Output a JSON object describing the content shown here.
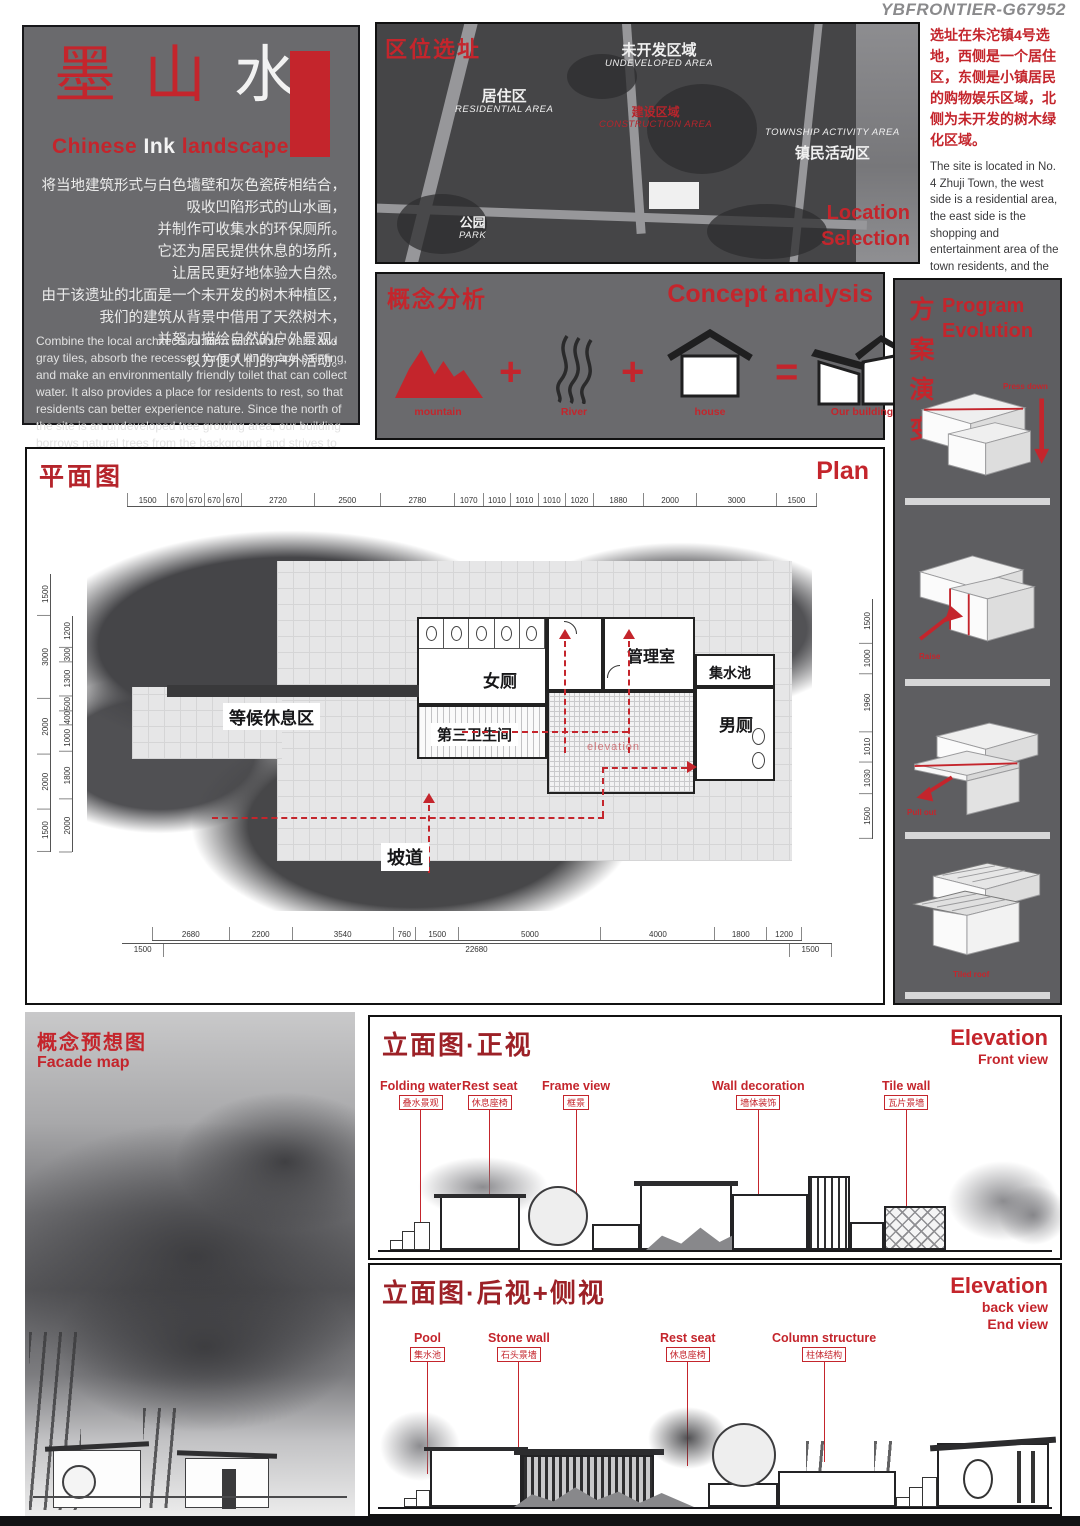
{
  "watermark": "YBFRONTIER-G67952",
  "intro": {
    "title_chars": [
      "墨",
      "山",
      "水"
    ],
    "subtitle_words": [
      "Chinese",
      "Ink",
      "landscape"
    ],
    "cn_lines": [
      "将当地建筑形式与白色墙壁和灰色瓷砖相结合，",
      "吸收凹陷形式的山水画，",
      "并制作可收集水的环保厕所。",
      "它还为居民提供休息的场所，",
      "让居民更好地体验大自然。",
      "由于该遗址的北面是一个未开发的树木种植区，",
      "我们的建筑从背景中借用了天然树木，",
      "并努力描绘自然的户外景观，",
      "以方便人们的户外活动。"
    ],
    "en_text": "Combine the local architectural form with white walls and gray tiles, absorb the recessed form of landscape painting, and make an environmentally friendly toilet that can collect water. It also provides a place for residents to rest, so that residents can better experience nature. Since the north of the site is an undeveloped tree growing area, our building borrows natural trees from the background and strives to portray a natural outdoor landscape to facilitate people's outdoor activities."
  },
  "map": {
    "tag": "区位选址",
    "residential_cn": "居住区",
    "residential_en": "RESIDENTIAL AREA",
    "undeveloped_cn": "未开发区域",
    "undeveloped_en": "UNDEVELOPED AREA",
    "construction_cn": "建设区域",
    "construction_en": "CONSTRUCTION AREA",
    "township_en": "TOWNSHIP ACTIVITY AREA",
    "township_cn": "镇民活动区",
    "park_cn": "公园",
    "park_en": "PARK",
    "caption_line1": "Location",
    "caption_line2": "Selection"
  },
  "site": {
    "cn": "选址在朱沱镇4号选地，西侧是一个居住区，东侧是小镇居民的购物娱乐区域，北侧为未开发的树木绿化区域。",
    "en": "The site is located in No. 4 Zhuji Town, the west side is a residential area, the east side is the shopping and entertainment area of the town residents, and the north side is the undeveloped tree green area."
  },
  "concept": {
    "title_cn": "概念分析",
    "title_en": "Concept analysis",
    "labels": [
      "mountain",
      "River",
      "house",
      "Our building"
    ],
    "operators": [
      "+",
      "+",
      "="
    ]
  },
  "evolution": {
    "title_cn_chars": [
      "方",
      "案",
      "演",
      "变"
    ],
    "title_en_line1": "Program",
    "title_en_line2": "Evolution",
    "step_labels": [
      "Press down",
      "Raise",
      "Pull out",
      "Tiled roof"
    ]
  },
  "plan": {
    "title_cn": "平面图",
    "title_en": "Plan",
    "dims_top": [
      "1500",
      "670",
      "670",
      "670",
      "670",
      "2720",
      "2500",
      "2780",
      "1070",
      "1010",
      "1010",
      "1010",
      "1020",
      "1880",
      "2000",
      "3000",
      "1500"
    ],
    "dims_bottom": [
      "2680",
      "2200",
      "3540",
      "760",
      "1500",
      "5000",
      "4000",
      "1800",
      "1200"
    ],
    "dims_bottom_outer": [
      "1500",
      "22680",
      "1500"
    ],
    "dims_left_outer": [
      "1500",
      "3000",
      "2000",
      "2000",
      "1500"
    ],
    "dims_left_inner": [
      "1200",
      "300",
      "1300",
      "500",
      "400",
      "1000",
      "1800",
      "2000"
    ],
    "dims_right": [
      "1500",
      "1000",
      "1960",
      "1010",
      "1030",
      "1500"
    ],
    "rooms": {
      "women": "女厕",
      "management": "管理室",
      "pool": "集水池",
      "third_toilet": "第三卫生间",
      "men": "男厕"
    },
    "waiting_area": "等候休息区",
    "ramp": "坡道",
    "elevation_note": "elevation"
  },
  "facade": {
    "title_cn": "概念预想图",
    "title_en": "Facade map"
  },
  "elev_front": {
    "title_cn": "立面图·正视",
    "title_en": "Elevation",
    "subtitle": "Front view",
    "labels": [
      {
        "en": "Folding water",
        "cn": "叠水景观"
      },
      {
        "en": "Rest seat",
        "cn": "休息座椅"
      },
      {
        "en": "Frame view",
        "cn": "框景"
      },
      {
        "en": "Wall decoration",
        "cn": "墙体装饰"
      },
      {
        "en": "Tile wall",
        "cn": "瓦片景墙"
      }
    ]
  },
  "elev_back": {
    "title_cn": "立面图·后视+侧视",
    "title_en": "Elevation",
    "subtitle_line1": "back view",
    "subtitle_line2": "End view",
    "labels": [
      {
        "en": "Pool",
        "cn": "集水池"
      },
      {
        "en": "Stone wall",
        "cn": "石头景墙"
      },
      {
        "en": "Rest seat",
        "cn": "休息座椅"
      },
      {
        "en": "Column structure",
        "cn": "柱体结构"
      }
    ]
  }
}
